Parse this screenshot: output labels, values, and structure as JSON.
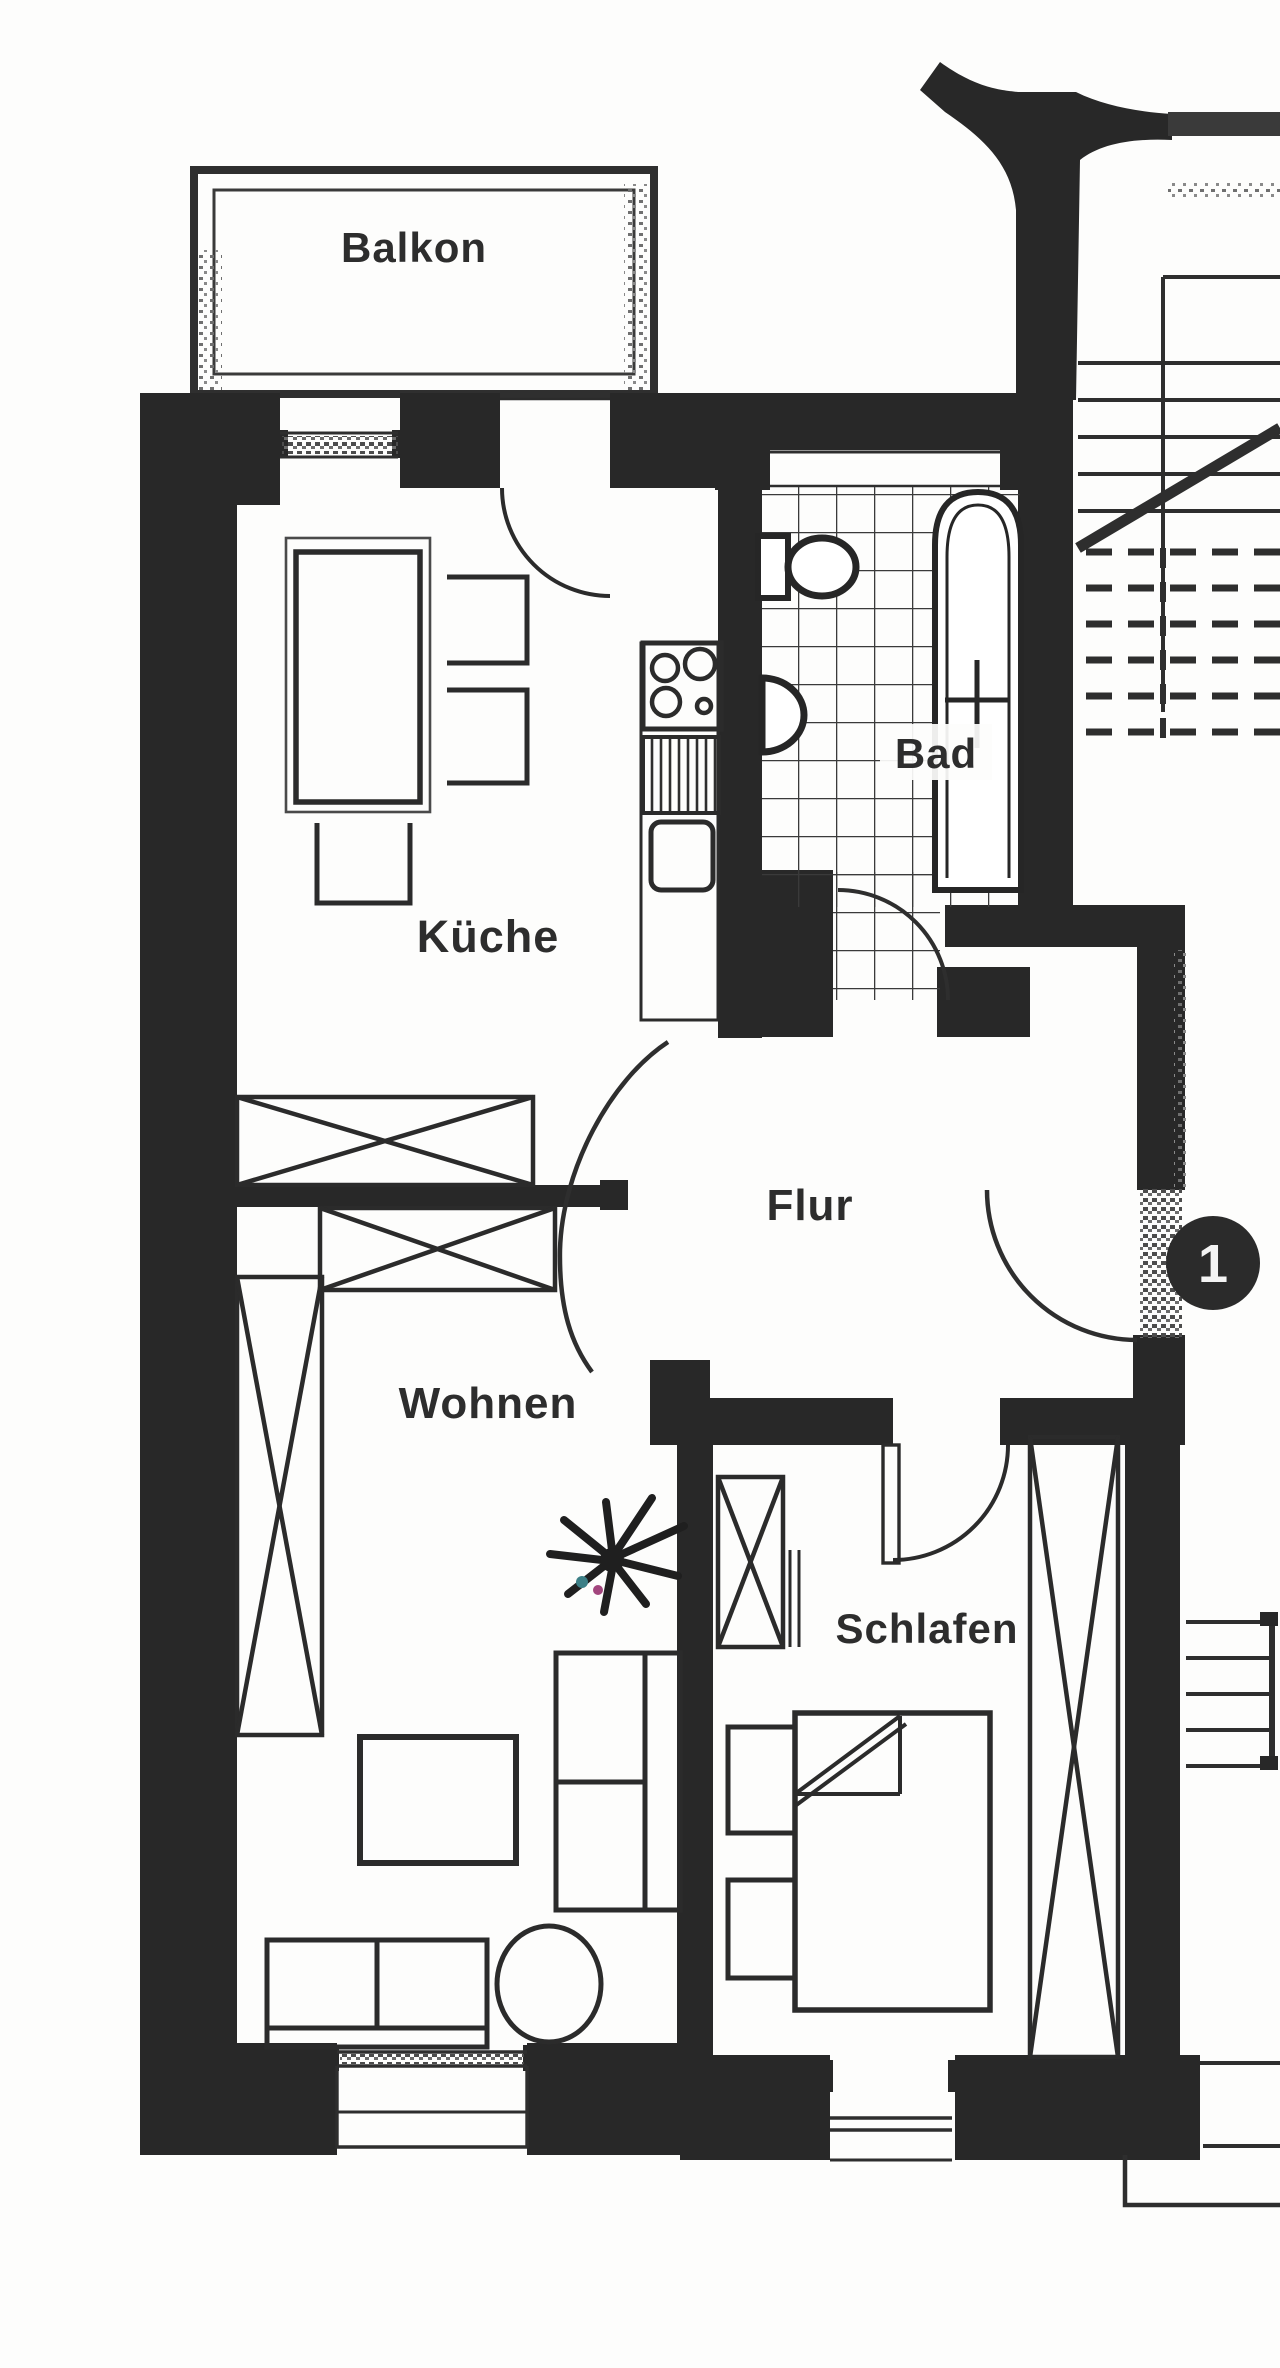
{
  "document": {
    "type": "floor-plan-scan",
    "language": "de"
  },
  "plan": {
    "labels": {
      "balkon": "Balkon",
      "kueche": "Küche",
      "bad": "Bad",
      "flur": "Flur",
      "wohnen": "Wohnen",
      "schlafen": "Schlafen"
    },
    "entrance_badge": {
      "value": "1",
      "bg": "#2b2b2b",
      "text_color": "#f4f4f4"
    },
    "colors": {
      "ink": "#2a2a2a",
      "wall_fill": "#282828",
      "paper": "#fdfdfc",
      "tile_line": "#3a3a3a",
      "scan_gray": "#777777",
      "plant_speck_teal": "#3c7f86",
      "plant_speck_magenta": "#a2457d"
    },
    "icons": [
      "bathtub-icon",
      "toilet-icon",
      "washbasin-icon",
      "stove-icon",
      "dishwasher-icon",
      "kitchen-sink-icon",
      "plant-icon",
      "bed-icon",
      "sofa-icon",
      "wardrobe-icon",
      "stairs-icon",
      "door-swing-icon"
    ]
  }
}
